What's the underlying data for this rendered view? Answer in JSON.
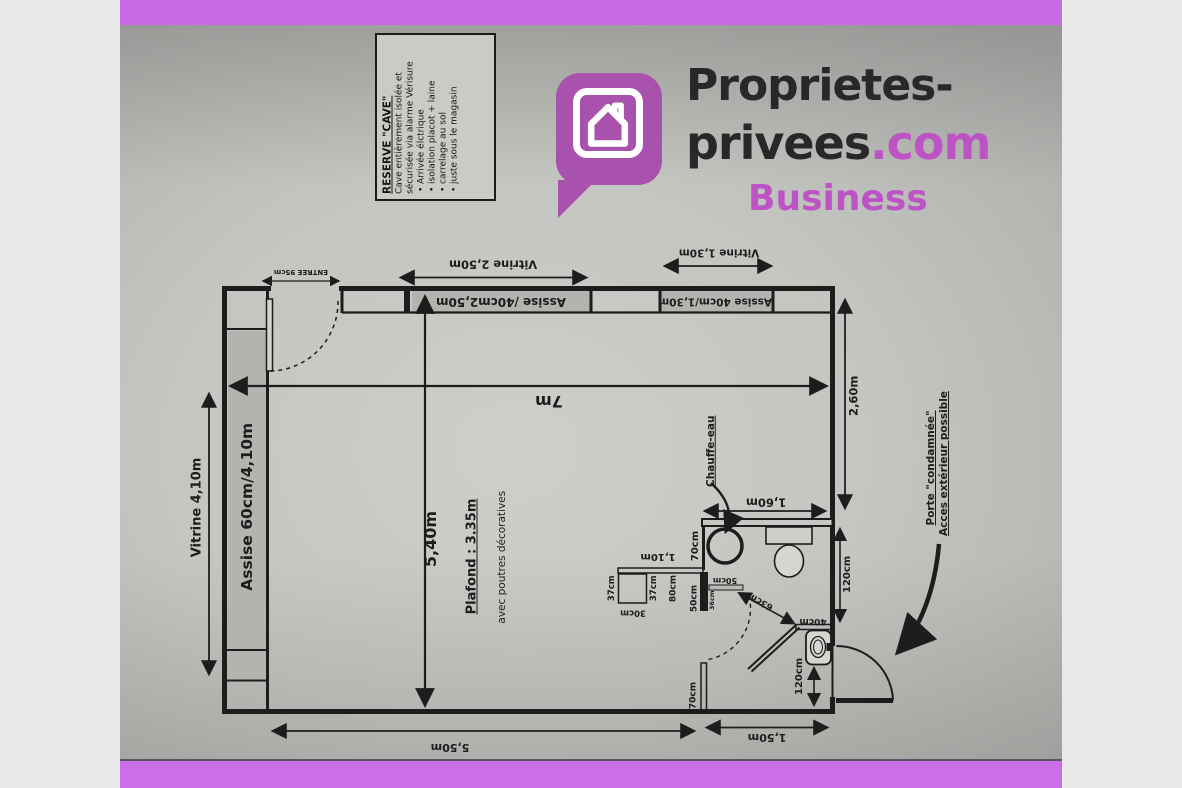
{
  "branding": {
    "name_line1": "Proprietes-",
    "name_line2": "privees",
    "name_line2_suffix": ".com",
    "name_line3": "Business",
    "icon": "house-speech-bubble-icon",
    "colors": {
      "banner_purple": "#c76ae3",
      "bubble_purple": "#a851ad",
      "accent_purple": "#bd53c5",
      "text_dark": "#2a272a"
    }
  },
  "reserve_note": {
    "title": "RESERVE \"CAVE\"",
    "line1": "Cave entièrement isolée et",
    "line2": "sécurisée via alarme Vérisure",
    "bullets": [
      "Arrivée élctrique",
      "isolation placot + laine",
      "carrelage au sol",
      "juste sous le magasin"
    ]
  },
  "plan": {
    "ink_color": "#1d1d1d",
    "shade_color": "#b2b4af",
    "paper_color": "#c6c8c3",
    "labels": {
      "vitrine_left": "Vitrine 4,10m",
      "assise_left": "Assise 60cm/4,10m",
      "entree": "ENTREE 95cm",
      "vitrine_top": "Vitrine 2,50m",
      "assise_top": "Assise /40cm2,50m",
      "vitrine_top_right": "Vitrine 1,30m",
      "assise_top_right": "Assise 40cm/1,30m",
      "width_total": "7m",
      "depth_left": "5,40m",
      "ceiling": "Plafond : 3.35m",
      "ceiling_note": "avec poutres décoratives",
      "chauffe_eau": "Chauffe-eau",
      "wc_top_width": "1,60m",
      "right_upper": "2,60m",
      "bath_wall_70": "70cm",
      "counter_110": "1,10m",
      "square_left_37": "37cm",
      "square_right_37": "37cm",
      "square_bottom_30": "30cm",
      "door_80": "80cm",
      "door_50_v": "50cm",
      "door_36": "36cm",
      "door_50_h": "50cm",
      "door_63": "63cm",
      "sink_40": "40cm",
      "right_120_upper": "120cm",
      "right_120_lower": "120cm",
      "stub_70": "70cm",
      "bottom_right_150": "1,50m",
      "bottom_left_550": "5,50m",
      "porte_line1": "Porte \"condamnée\"",
      "porte_line2": "Acces extérieur possible"
    }
  }
}
